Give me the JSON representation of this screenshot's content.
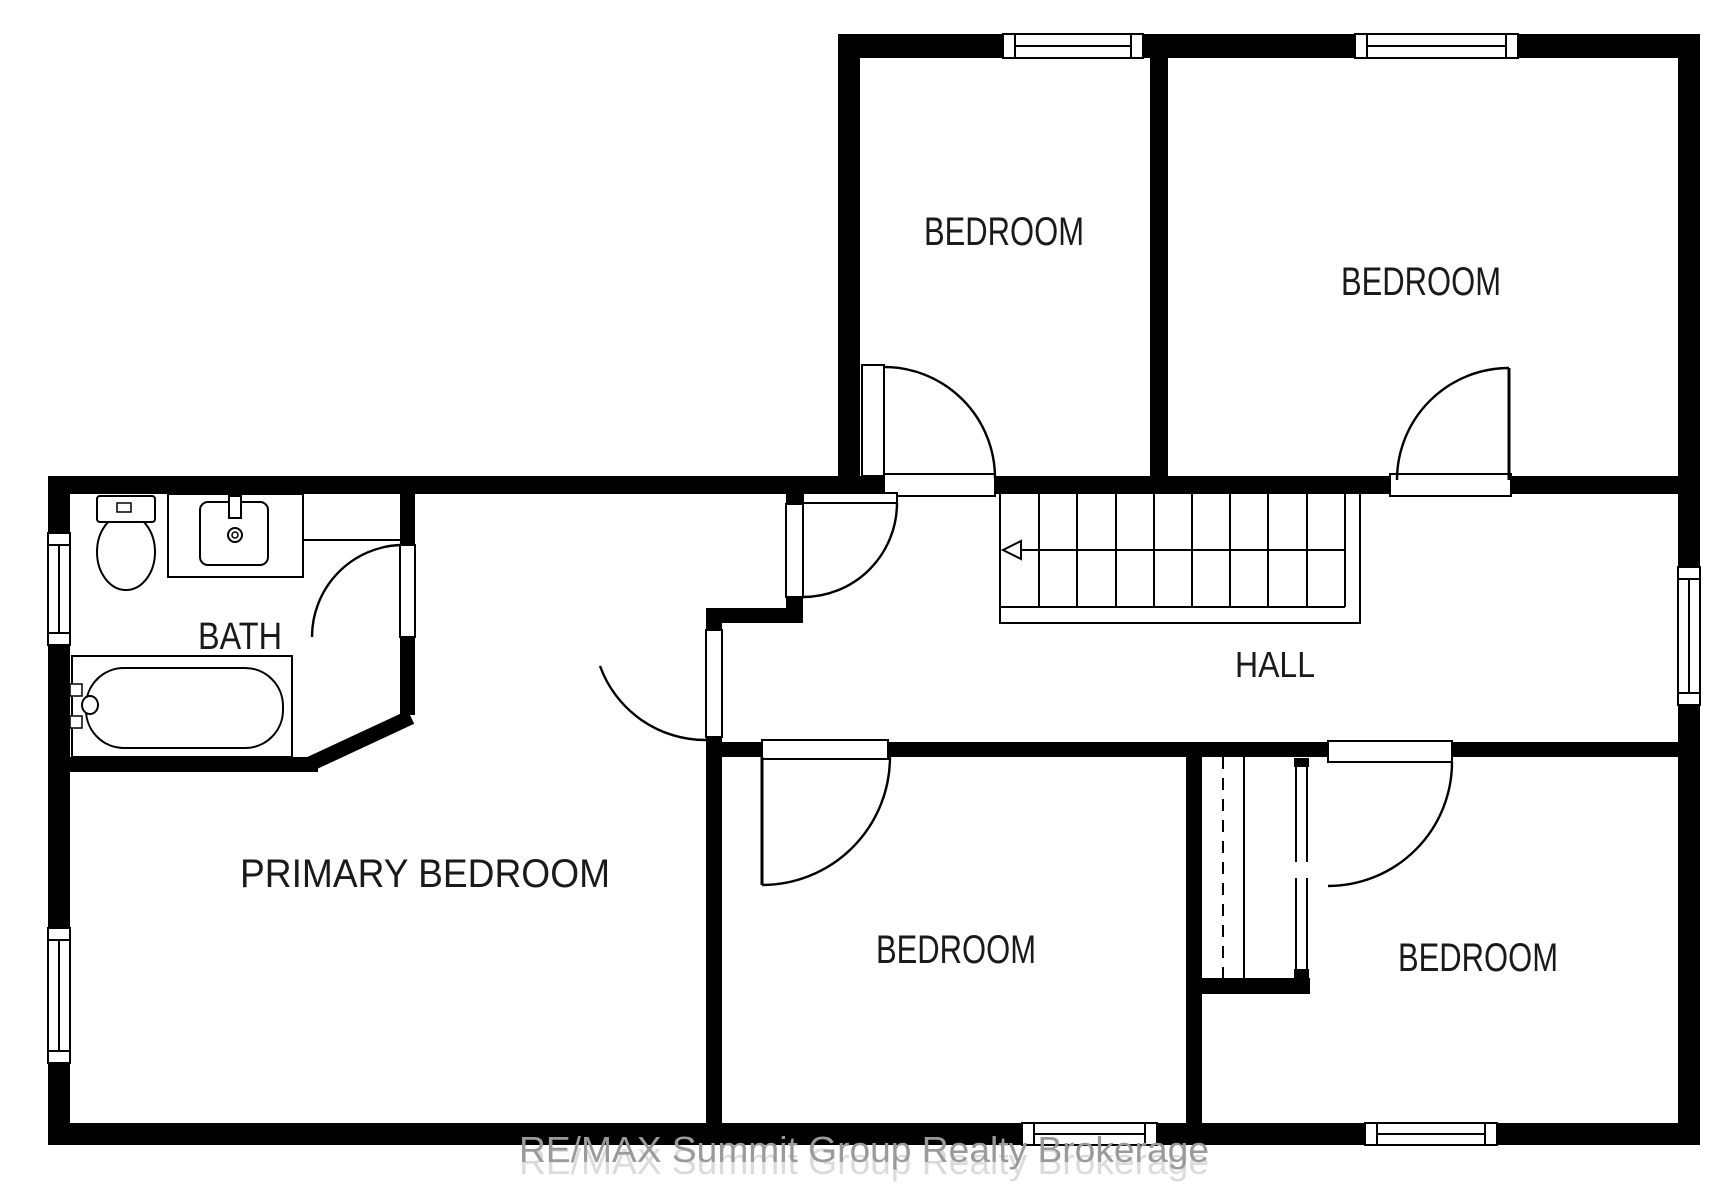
{
  "rooms": {
    "bedroom_top_left": {
      "label": "BEDROOM"
    },
    "bedroom_top_right": {
      "label": "BEDROOM"
    },
    "bedroom_middle": {
      "label": "BEDROOM"
    },
    "bedroom_bottom_right": {
      "label": "BEDROOM"
    },
    "primary_bedroom": {
      "label": "PRIMARY BEDROOM"
    },
    "bath": {
      "label": "BATH"
    },
    "hall": {
      "label": "HALL"
    }
  },
  "watermark": {
    "text": "RE/MAX Summit Group Realty Brokerage"
  },
  "colors": {
    "wall": "#000000",
    "background": "#ffffff",
    "label": "#1a1a1a",
    "watermark": "#9a9a9a",
    "watermark_shadow": "#d8d8d8"
  }
}
